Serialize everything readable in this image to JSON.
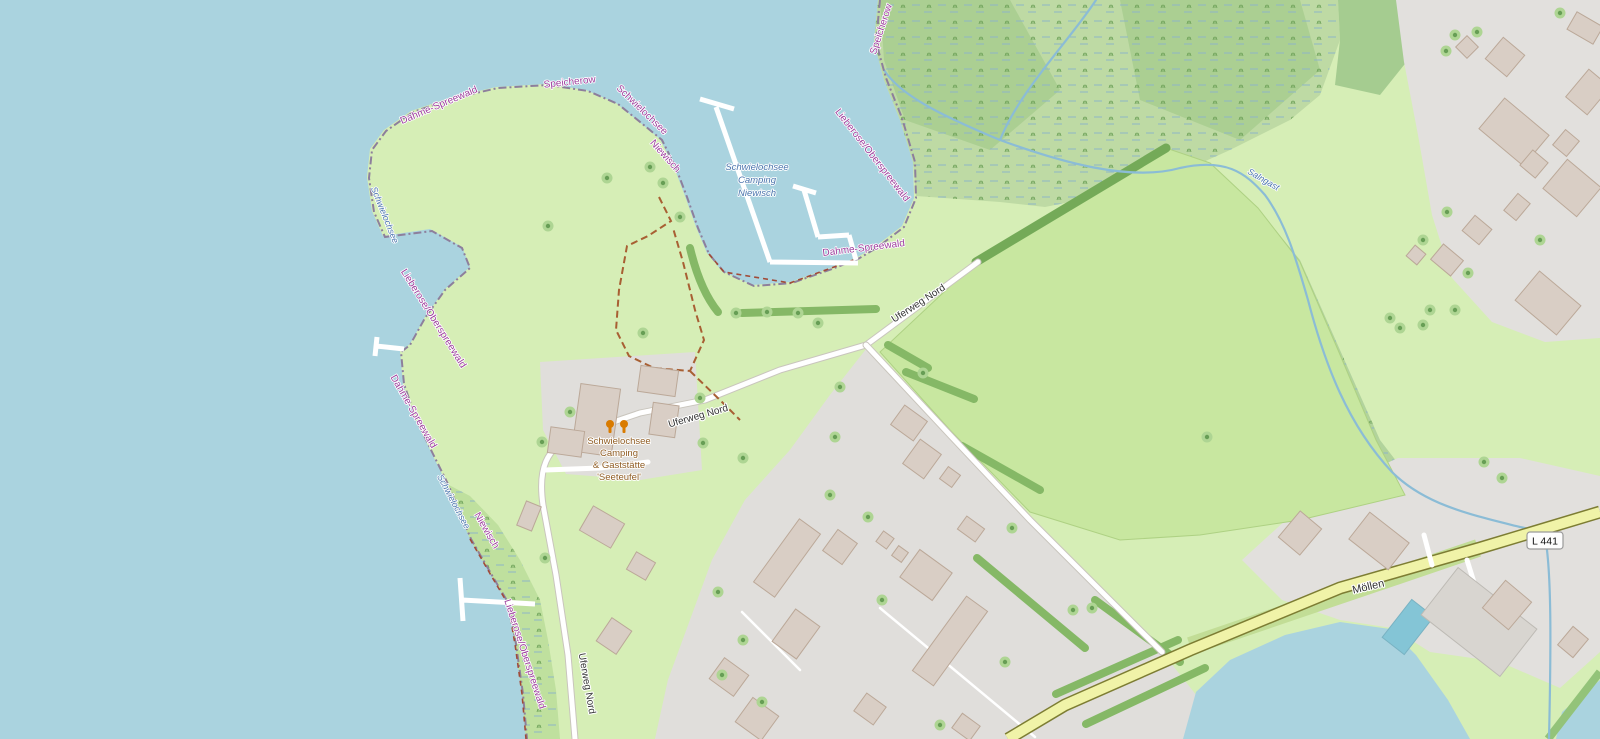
{
  "map_type": "openstreetmap-style map of Schwielochsee / Niewisch area",
  "labels": {
    "boundary": {
      "dahme_spreewald": "Dahme-Spreewald",
      "speicherow": "Speicherow",
      "schwielochsee": "Schwielochsee",
      "niewisch": "Niewisch",
      "lieberose_oberspreewald": "Lieberose/Oberspreewald"
    },
    "water": {
      "lake_name": "Schwielochsee",
      "stream_name": "Salngast"
    },
    "pois": {
      "camping_niewisch_lines": [
        "Schwielochsee",
        "Camping",
        "Niewisch"
      ],
      "camping_seeteufel_lines": [
        "Schwielochsee",
        "Camping",
        "& Gaststätte",
        "'Seeteufel'"
      ]
    },
    "roads": {
      "uferweg_nord": "Uferweg Nord",
      "moellen": "Möllen",
      "l441_ref": "L 441"
    }
  },
  "icons": {
    "restaurant": "restaurant-icon"
  },
  "colors": {
    "water": "#aad3df",
    "land_base": "#d6eeb6",
    "field_green": "#c8e7a0",
    "wetland_green": "#bedaa4",
    "forest_green": "#a8cd90",
    "residential_gray": "#e2e0dd",
    "building_fill": "#d9cec5",
    "secondary_road_yellow": "#f0f3a8",
    "road_white": "#ffffff",
    "boundary_purple": "#9d3e9d",
    "water_label_blue": "#4a74ad",
    "poi_brown": "#8f5c22",
    "poi_icon_orange": "#d97b00",
    "pool_blue": "#84c5d6"
  }
}
